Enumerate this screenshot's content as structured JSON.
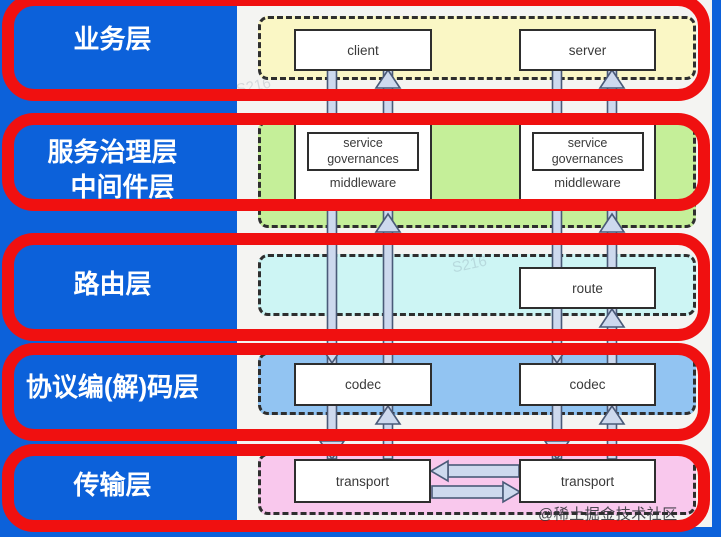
{
  "diagram": {
    "rows": [
      {
        "label_lines": [
          "业务层"
        ],
        "band_color": "#faf7c5"
      },
      {
        "label_lines": [
          "服务治理层",
          "中间件层"
        ],
        "band_color": "#c5ef99"
      },
      {
        "label_lines": [
          "路由层"
        ],
        "band_color": "#cdf5f4"
      },
      {
        "label_lines": [
          "协议编(解)码层"
        ],
        "band_color": "#92c4f2"
      },
      {
        "label_lines": [
          "传输层"
        ],
        "band_color": "#f9c8ed"
      }
    ],
    "nodes": {
      "client": "client",
      "server": "server",
      "service_governances": "service governances",
      "middleware": "middleware",
      "route": "route",
      "codec": "codec",
      "transport": "transport"
    },
    "colors": {
      "background": "#0c61da",
      "panel": "#f4f4f2",
      "highlight_border": "#f01010",
      "arrow_fill": "#cdd9ee",
      "arrow_stroke": "#4a5a78"
    },
    "watermarks": {
      "signature": "@稀土掘金技术社区",
      "faint": "S216"
    }
  }
}
